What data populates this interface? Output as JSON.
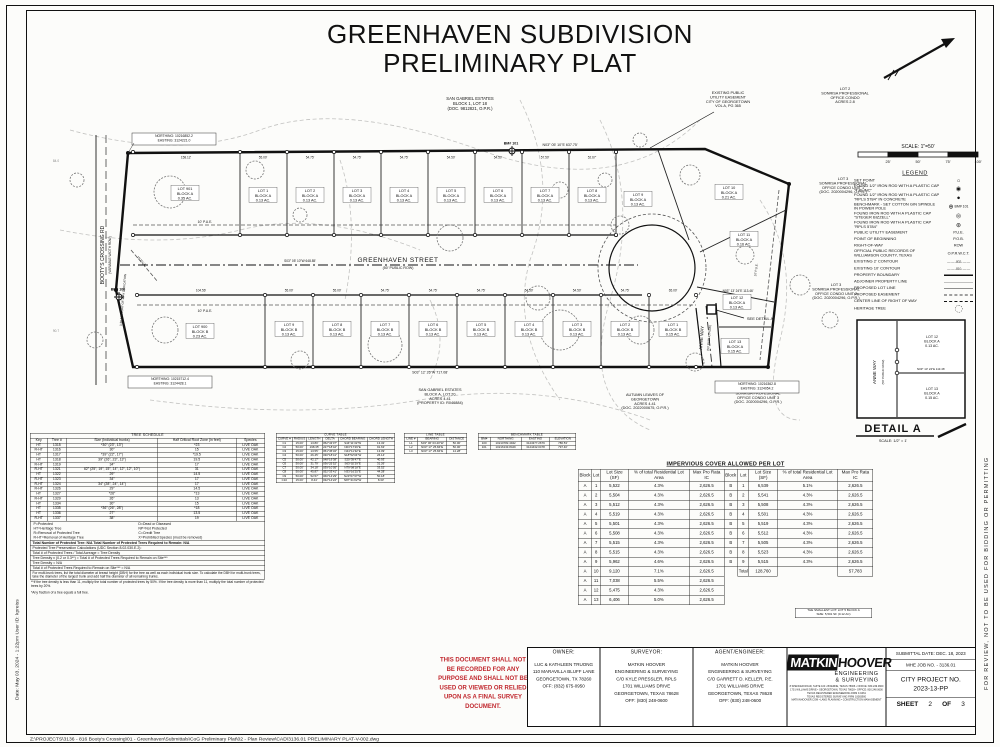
{
  "sheet": {
    "title1": "GREENHAVEN SUBDIVISION",
    "title2": "PRELIMINARY PLAT",
    "scale_label": "SCALE: 1\"=50'",
    "scale_ticks": [
      "25'",
      "50'",
      "75'",
      "100'"
    ]
  },
  "edges": {
    "left_note": "Date: May 03, 2024 - 1:22pm    User ID: kpreiss",
    "right_note": "FOR REVIEW, NOT TO BE USED FOR BIDDING OR PERMITTING",
    "file_path": "Z:\\PROJECTS\\3136 - 816 Booty's Crossing\\01 - Greenhaven\\Submittals\\CoG Preliminary Plat\\02 - Plan Review\\CAD\\3136.01 PRELIMINARY PLAT-V-002.dwg"
  },
  "legend": {
    "title": "LEGEND",
    "items": [
      {
        "label": "SET POINT",
        "sym": "circle-open"
      },
      {
        "label": "FOUND 1/2\" IRON ROD WITH A PLASTIC CAP \"TJS INC\"",
        "sym": "circle-dot"
      },
      {
        "label": "FOUND 1/2\" IRON ROD WITH A PLASTIC CAP \"RPLS 5784\" IN CONCRETE",
        "sym": "circle-filled"
      },
      {
        "label": "BENCHMARK - SET COTTON GIN SPINDLE IN POWER POLE",
        "sym": "benchmark",
        "note": "BM# 101"
      },
      {
        "label": "FOUND IRON ROD WITH A PLASTIC CAP \"STEGER BIZZELL\"",
        "sym": "circle-ring"
      },
      {
        "label": "FOUND IRON ROD WITH A PLASTIC CAP \"RPLS 5784\"",
        "sym": "circle-star"
      },
      {
        "label": "PUBLIC UTILITY EASEMENT",
        "sym": "text",
        "text": "P.U.E."
      },
      {
        "label": "POINT OF BEGINNING",
        "sym": "text",
        "text": "P.O.B."
      },
      {
        "label": "RIGHT-OF-WAY",
        "sym": "text",
        "text": "ROW"
      },
      {
        "label": "OFFICIAL PUBLIC RECORDS OF WILLIAMSON COUNTY, TEXAS",
        "sym": "text",
        "text": "O.P.R.W.C.T."
      },
      {
        "label": "EXISTING 2' CONTOUR",
        "sym": "contour",
        "text": "— — -802- — —"
      },
      {
        "label": "EXISTING 10' CONTOUR",
        "sym": "contour",
        "text": "— — -810- — —"
      },
      {
        "label": "PROPERTY BOUNDARY",
        "sym": "line-thick"
      },
      {
        "label": "ADJOINER PROPERTY LINE",
        "sym": "line-thin"
      },
      {
        "label": "PROPOSED LOT LINE",
        "sym": "line-med"
      },
      {
        "label": "PROPOSED EASEMENT",
        "sym": "line-dashed"
      },
      {
        "label": "CENTER LINE OF RIGHT OF WAY",
        "sym": "line-dashdot"
      },
      {
        "label": "HERITAGE TREE",
        "sym": "tree"
      }
    ]
  },
  "plat": {
    "streets": {
      "greenhaven": "GREENHAVEN STREET",
      "greenhaven_sub": "(50' PUBLIC ROW)",
      "anne": "ANNE WAY",
      "anne_sub": "(50' PUBLIC ROW)",
      "bootys": "BOOTY'S CROSSING RD",
      "bootys_sub": "(VARIABLE WIDTH ROW)"
    },
    "lots_block_a": [
      {
        "name": "LOT 901",
        "block": "BLOCK A",
        "area": "0.35 AC."
      },
      {
        "name": "LOT 1",
        "block": "BLOCK A",
        "area": "0.13 AC."
      },
      {
        "name": "LOT 2",
        "block": "BLOCK A",
        "area": "0.13 AC."
      },
      {
        "name": "LOT 3",
        "block": "BLOCK A",
        "area": "0.13 AC."
      },
      {
        "name": "LOT 4",
        "block": "BLOCK A",
        "area": "0.13 AC."
      },
      {
        "name": "LOT 5",
        "block": "BLOCK A",
        "area": "0.13 AC."
      },
      {
        "name": "LOT 6",
        "block": "BLOCK A",
        "area": "0.13 AC."
      },
      {
        "name": "LOT 7",
        "block": "BLOCK A",
        "area": "0.13 AC."
      },
      {
        "name": "LOT 8",
        "block": "BLOCK A",
        "area": "0.13 AC."
      },
      {
        "name": "LOT 9",
        "block": "BLOCK A",
        "area": "0.13 AC."
      },
      {
        "name": "LOT 10",
        "block": "BLOCK A",
        "area": "0.21 AC."
      },
      {
        "name": "LOT 11",
        "block": "BLOCK A",
        "area": "0.16 AC."
      },
      {
        "name": "LOT 12",
        "block": "BLOCK A",
        "area": "0.13 AC."
      },
      {
        "name": "LOT 13",
        "block": "BLOCK A",
        "area": "0.15 AC."
      }
    ],
    "lots_block_b": [
      {
        "name": "LOT 900",
        "block": "BLOCK B",
        "area": "0.23 AC."
      },
      {
        "name": "LOT 9",
        "block": "BLOCK B",
        "area": "0.13 AC."
      },
      {
        "name": "LOT 8",
        "block": "BLOCK B",
        "area": "0.13 AC."
      },
      {
        "name": "LOT 7",
        "block": "BLOCK B",
        "area": "0.13 AC."
      },
      {
        "name": "LOT 6",
        "block": "BLOCK B",
        "area": "0.13 AC."
      },
      {
        "name": "LOT 5",
        "block": "BLOCK B",
        "area": "0.13 AC."
      },
      {
        "name": "LOT 4",
        "block": "BLOCK B",
        "area": "0.13 AC."
      },
      {
        "name": "LOT 3",
        "block": "BLOCK B",
        "area": "0.13 AC."
      },
      {
        "name": "LOT 2",
        "block": "BLOCK B",
        "area": "0.13 AC."
      },
      {
        "name": "LOT 1",
        "block": "BLOCK B",
        "area": "0.15 AC."
      }
    ],
    "dim_top_widths": [
      "158.12'",
      "55.00'",
      "54.75'",
      "54.75'",
      "54.75'",
      "54.50'",
      "54.50'",
      "57.50'",
      "52.67'"
    ],
    "dim_bottom_widths": [
      "104.56'",
      "55.00'",
      "55.00'",
      "54.75'",
      "54.75'",
      "54.75'",
      "54.50'",
      "54.50'",
      "54.75'",
      "65.00'"
    ],
    "misc": {
      "bearing_top": "N03° 05' 10\"E   637.75'",
      "bearing_cl": "S03° 05' 10\"W   648.85'",
      "bearing_bottom": "S03° 12' 26\"W   717.08'",
      "anne_dim": "N03° 13' 24\"E   113.46'",
      "pue10": "10' P.U.E.",
      "pue15": "15' P.U.E.",
      "row_dedication": "0.38 AC RIGHT-OF-WAY DEDICATION",
      "bm101": "BM# 101",
      "bm100": "BM# 100",
      "see_detail": "SEE DETAIL A",
      "contour_a": "84.0",
      "contour_b": "90.7"
    },
    "annotations": {
      "sg_top": [
        "SAN GABRIEL ESTATES",
        "BLOCK 1, LOT 18",
        "(DOC. 9812821, O.P.R.)"
      ],
      "ex_pue": [
        "EXISTING PUBLIC",
        "UTILITY EASEMENT",
        "CITY OF GEORGETOWN",
        "VOL A, PG 365"
      ],
      "lot2_sonrisa": [
        "LOT 2",
        "SONRISA PROFESSIONAL",
        "OFFICE CONDO",
        "ACRES 2.8"
      ],
      "lot3_unit1": [
        "LOT 3",
        "SONRISA PROFESSIONAL",
        "OFFICE CONDO UNIT 1",
        "(DOC. 2020004296, O.P.R.)"
      ],
      "lot3_unit2": [
        "LOT 3",
        "SONRISA PROFESSIONAL",
        "OFFICE CONDO UNIT 2",
        "(DOC. 2020004296, O.P.R.)"
      ],
      "lot3_unit3": [
        "LOT 3",
        "SONRISA PROFESIONAL",
        "OFFICE CONDO UNIT 3",
        "(DOC. 2020004296, O.P.R.)"
      ],
      "autumn": [
        "AUTUMN LEAVES OF",
        "GEORGETOWN",
        "ACRES 4.41",
        "(DOC. 2022000675, O.P.R.)"
      ],
      "sg_bottom": [
        "SAN GABRIEL ESTATES",
        "BLOCK A, LOT 20",
        "ACRES 4.41",
        "(PROPERTY ID: R046884)"
      ],
      "ne_tl": [
        "NORTHING: 10216852.2",
        "EASTING: 3124221.0"
      ],
      "ne_bl": [
        "NORTHING: 10215712.4",
        "EASTING: 3124428.1"
      ],
      "ne_br": [
        "NORTHING: 10216362.8",
        "EASTING: 3124054.2"
      ]
    }
  },
  "detail_a": {
    "title": "DETAIL A",
    "scale": "SCALE: 1/2\" = 1'",
    "street": "ANNE WAY",
    "street_sub": "(50' PUBLIC ROW)",
    "lot_top": [
      "LOT 12",
      "BLOCK A",
      "0.13 AC."
    ],
    "lot_bottom": [
      "LOT 13",
      "BLOCK A",
      "0.15 AC."
    ],
    "dim": "N03° 13' 24\"E  113.46'"
  },
  "tables": {
    "tree": {
      "title": "TREE SCHEDULE",
      "headers": [
        "Key",
        "Tree #",
        "Size (Individual trunks)",
        "Half Critical Root Zone (in feet)",
        "Species"
      ],
      "rows": [
        [
          "HT",
          "1315",
          "*30\" (23\", 13\")",
          "*23",
          "LIVE OAK"
        ],
        [
          "R-HT",
          "1316",
          "30\"",
          "15",
          "LIVE OAK"
        ],
        [
          "HT",
          "1317",
          "*39\" (22\", 17\")",
          "*19.5",
          "LIVE OAK"
        ],
        [
          "HT",
          "1318",
          "39\" (26\", 23\", 13\")",
          "19.5",
          "LIVE OAK"
        ],
        [
          "R-HT",
          "1319",
          "34\"",
          "17",
          "LIVE OAK"
        ],
        [
          "R-HT",
          "1321",
          "62\" (25\", 19\", 15\", 14\", 12\", 12\", 10\")",
          "31",
          "LIVE OAK"
        ],
        [
          "HT",
          "1322",
          "29\"",
          "14.5",
          "LIVE OAK"
        ],
        [
          "R-HT",
          "1323",
          "34\"",
          "17",
          "LIVE OAK"
        ],
        [
          "R-HT",
          "1324",
          "34\" (28\", 24\", 14\")",
          "17",
          "LIVE OAK"
        ],
        [
          "R-HT",
          "1326",
          "29\"",
          "14.5",
          "LIVE OAK"
        ],
        [
          "HT",
          "1327",
          "*26\"",
          "*13",
          "LIVE OAK"
        ],
        [
          "R-HT",
          "1329",
          "26\"",
          "13",
          "LIVE OAK"
        ],
        [
          "HT",
          "1334",
          "30\"",
          "15",
          "LIVE OAK"
        ],
        [
          "HT",
          "1335",
          "*36\" (26\", 28\")",
          "*18",
          "LIVE OAK"
        ],
        [
          "HT",
          "1336",
          "27\"",
          "13.5",
          "LIVE OAK"
        ],
        [
          "R-HT",
          "1337",
          "38\"",
          "19",
          "LIVE OAK"
        ]
      ],
      "legend_title": "Legend",
      "legend_pairs": [
        [
          "P=Protected",
          "D=Dead or Diseased"
        ],
        [
          "HT=Heritage Tree",
          "NP=Not Protected"
        ],
        [
          "R=Removal of Protected Tree",
          "C=Credit Tree"
        ],
        [
          "R-HT=Removal of Heritage Tree",
          "X=Prohibited Species (must be removed)"
        ]
      ],
      "totals_line": "Total Number of Protected Tree: N/A        Total Number of Protected Trees Required to Remain: N/A",
      "calc_lines": [
        "Protected Tree Preservation Calculations (UDC Section 8.02.030.E.2):",
        "Total # of Protected Trees / Total Acreage = Tree Density",
        "Tree Density x (0.2 or 0.3**) = Total # of Protected Trees Required to Remain on Site***",
        "Tree Density = N/A",
        "Total # of Protected Trees Required to Remain on Site*** = N/A"
      ],
      "multi_note": "For multi-trunk trees, list the total diameter at breast height (DBH) for the tree as well as each individual trunk size. To calculate the DBH for multi-trunk trees, take the diameter of the largest trunk and add half the diameter of all remaining trunks.",
      "footnotes": [
        "**If the tree density is less than 11, multiply the total number of protected trees by 50%. If the tree density is more than 11, multiply the total number of protected trees by 20%.",
        "*Any fraction of a tree equals a full tree."
      ]
    },
    "curve": {
      "title": "CURVE TABLE",
      "headers": [
        "CURVE #",
        "RADIUS",
        "LENGTH",
        "DELTA",
        "CHORD BEARING",
        "CHORD LENGTH"
      ],
      "rows": [
        [
          "C1",
          "15.00'",
          "13.80'",
          "052°43'07\"",
          "S44°11'32\"W",
          "13.32'"
        ],
        [
          "C2",
          "50.00'",
          "198.35'",
          "227°18'42\"",
          "N03°17'26\"E",
          "91.63'"
        ],
        [
          "C3",
          "15.00'",
          "13.55'",
          "051°45'32\"",
          "N44°11'32\"E",
          "13.09'"
        ],
        [
          "C4",
          "50.00'",
          "26.45'",
          "030°18'41\"",
          "S18°52'04\"W",
          "26.14'"
        ],
        [
          "C5",
          "50.00'",
          "42.17'",
          "048°19'38\"",
          "S20°39'47\"E",
          "40.93'"
        ],
        [
          "C6",
          "50.00'",
          "31.79'",
          "036°25'52\"",
          "S63°02'29\"E",
          "31.26'"
        ],
        [
          "C7",
          "50.00'",
          "34.18'",
          "039°10'05\"",
          "N79°08'18\"E",
          "33.52'"
        ],
        [
          "C8",
          "50.00'",
          "45.87'",
          "052°33'41\"",
          "N33°16'25\"E",
          "44.28'"
        ],
        [
          "C9",
          "50.00'",
          "52.57'",
          "060°14'29\"",
          "N23°07'37\"W",
          "50.18'"
        ],
        [
          "C10",
          "15.00'",
          "8.44'",
          "032°14'22\"",
          "N87°41'02\"W",
          "8.33'"
        ]
      ]
    },
    "line": {
      "title": "LINE TABLE",
      "headers": [
        "LINE #",
        "BEARING",
        "DISTANCE"
      ],
      "rows": [
        [
          "L1",
          "S03° 06' 03.40\"W",
          "50.00'"
        ],
        [
          "L2",
          "N03° 17' 25.84\"E",
          "50.00'"
        ],
        [
          "L3",
          "N03° 17' 25.84\"E",
          "14.28'"
        ]
      ]
    },
    "benchmark": {
      "title": "BENCHMARK TABLE",
      "headers": [
        "BM#",
        "NORTHING",
        "EASTING",
        "ELEVATION"
      ],
      "rows": [
        [
          "100",
          "10210782.4942",
          "3124377.2679",
          "786.53'"
        ],
        [
          "101",
          "10216133.8429",
          "3124432.0478",
          "797.40'"
        ]
      ]
    },
    "impervious": {
      "title": "IMPERVIOUS COVER ALLOWED PER LOT",
      "headers": [
        "Block",
        "Lot",
        "Lot Size (SF)",
        "% of total Residential Lot Area",
        "Max Pro Rata IC",
        "Block",
        "Lot",
        "Lot Size (SF)",
        "% of total Residential Lot Area",
        "Max Pro Rata IC"
      ],
      "rows": [
        [
          "A",
          "1",
          "5,522",
          "4.3%",
          "2,626.5",
          "B",
          "1",
          "6,539",
          "5.1%",
          "2,626.5"
        ],
        [
          "A",
          "2",
          "5,504",
          "4.3%",
          "2,626.5",
          "B",
          "2",
          "5,541",
          "4.3%",
          "2,626.5"
        ],
        [
          "A",
          "3",
          "5,512",
          "4.3%",
          "2,626.5",
          "B",
          "3",
          "5,508",
          "4.3%",
          "2,626.5"
        ],
        [
          "A",
          "4",
          "5,519",
          "4.3%",
          "2,626.5",
          "B",
          "4",
          "5,501",
          "4.3%",
          "2,626.5"
        ],
        [
          "A",
          "5",
          "5,501",
          "4.3%",
          "2,626.5",
          "B",
          "5",
          "5,519",
          "4.3%",
          "2,626.5"
        ],
        [
          "A",
          "6",
          "5,508",
          "4.3%",
          "2,626.5",
          "B",
          "6",
          "5,512",
          "4.3%",
          "2,626.5"
        ],
        [
          "A",
          "7",
          "5,515",
          "4.3%",
          "2,626.5",
          "B",
          "7",
          "5,505",
          "4.3%",
          "2,626.5"
        ],
        [
          "A",
          "8",
          "5,515",
          "4.3%",
          "2,626.5",
          "B",
          "8",
          "5,523",
          "4.3%",
          "2,626.5"
        ],
        [
          "A",
          "9",
          "5,962",
          "4.6%",
          "2,626.5",
          "B",
          "9",
          "5,515",
          "4.3%",
          "2,626.5"
        ],
        [
          "A",
          "10",
          "9,120",
          "7.1%",
          "2,626.5",
          "",
          "Total",
          "128,760",
          "",
          "57,783"
        ],
        [
          "A",
          "11",
          "7,038",
          "5.5%",
          "2,626.5",
          "",
          "",
          "",
          "",
          ""
        ],
        [
          "A",
          "12",
          "5,475",
          "4.3%",
          "2,626.5",
          "",
          "",
          "",
          "",
          ""
        ],
        [
          "A",
          "13",
          "6,406",
          "5.0%",
          "2,626.5",
          "",
          "",
          "",
          "",
          ""
        ]
      ],
      "note": [
        "THE SMALLEST LOT: LOT 5 BLOCK A",
        "SIZE: 5,501 SF (0.12 AC)"
      ]
    }
  },
  "stamp": {
    "lines": [
      "THIS DOCUMENT SHALL NOT",
      "BE RECORDED FOR ANY",
      "PURPOSE AND SHALL NOT BE",
      "USED OR VIEWED OR RELIED",
      "UPON AS A FINAL SURVEY",
      "DOCUMENT."
    ]
  },
  "title_block": {
    "owner": {
      "head": "OWNER:",
      "lines": [
        "LUC & KATHLEEN TRUONG",
        "110 MARAVILLA BLUFF LANE",
        "GEORGETOWN, TX 78260",
        "OFF: (832) 675-0950"
      ]
    },
    "surveyor": {
      "head": "SURVEYOR:",
      "lines": [
        "MATKIN HOOVER",
        "ENGINEERING & SURVEYING",
        "C/O KYLE PRESSLER, RPLS",
        "1701 WILLIAMS DRIVE",
        "GEORGETOWN, TEXAS 78628",
        "OFF: (830) 248-0600"
      ]
    },
    "agent": {
      "head": "AGENT/ENGINEER:",
      "lines": [
        "MATKIN HOOVER",
        "ENGINEERING & SURVEYING",
        "C/O GARRETT D. KELLER, P.E.",
        "1701 WILLIAMS DRIVE",
        "GEORGETOWN, TEXAS 78628",
        "OFF: (830) 248-0600"
      ]
    },
    "logo": {
      "matkin": "MATKIN",
      "hoover": "HOOVER",
      "sub1": "ENGINEERING",
      "sub2": "& SURVEYING",
      "fine": [
        "8 SPENCER ROAD, SUITE 100 • BOERNE, TEXAS 78006 • OFFICE: 830.249.0600",
        "1701 WILLIAMS DRIVE • GEORGETOWN, TEXAS 78628 • OFFICE: 830.248.0600",
        "TEXAS REGISTERED ENGINEERING FIRM F-9461",
        "TEXAS REGISTERED SURVEYING FIRM 10083900",
        "MATKINHOOVER.COM • LAND PLANNING • CONSTRUCTION MANAGEMENT"
      ]
    },
    "info": {
      "submittal": "SUBMITTAL DATE: DEC. 18, 2023",
      "job": "MHE JOB NO. - 3136.01",
      "city_label": "CITY PROJECT NO.",
      "city_no": "2023-13-PP",
      "sheet_label": "SHEET",
      "sheet_no": "2",
      "of_label": "OF",
      "sheet_total": "3"
    }
  }
}
